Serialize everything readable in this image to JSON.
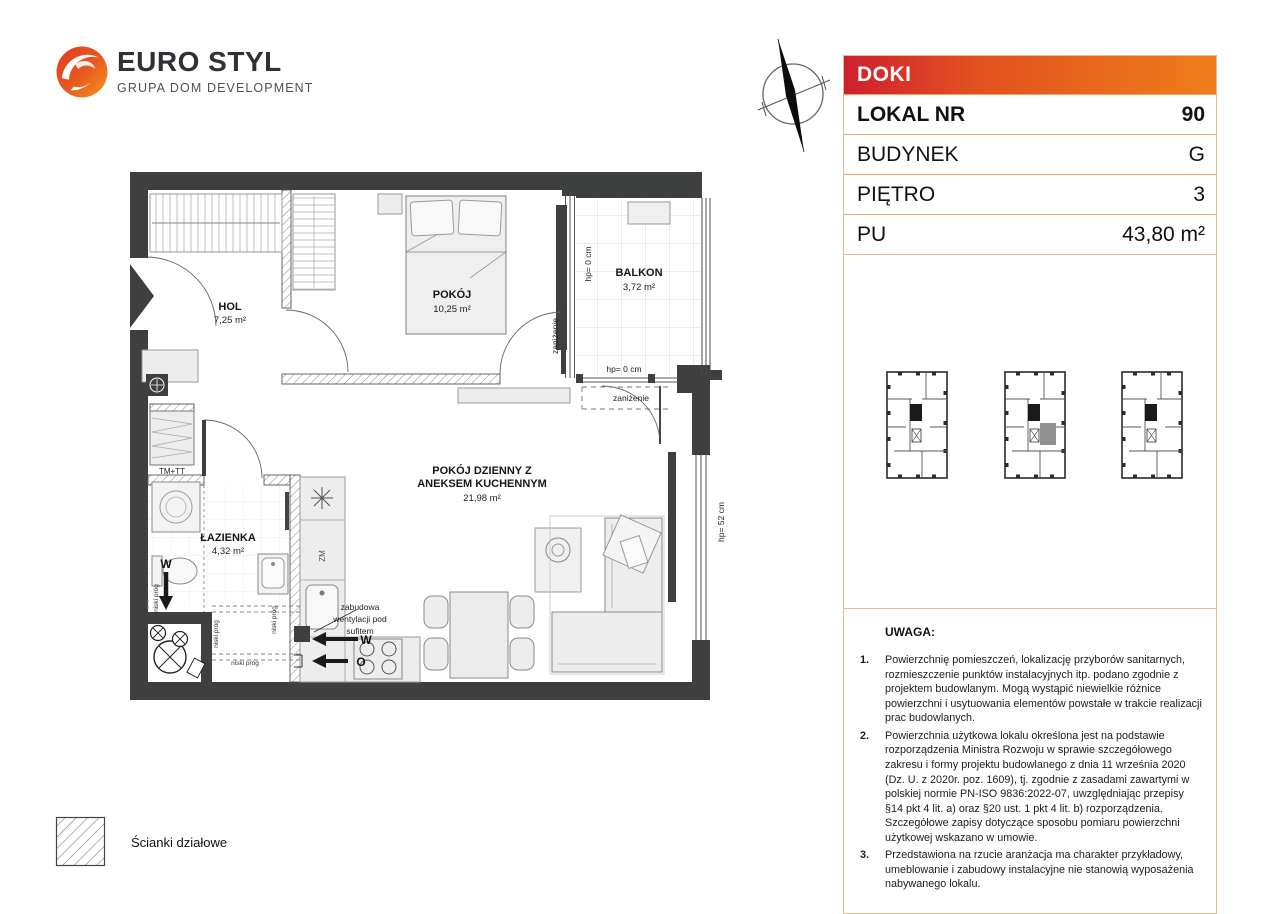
{
  "logo": {
    "title": "EURO STYL",
    "subtitle": "GRUPA DOM DEVELOPMENT"
  },
  "info_panel": {
    "project_name": "DOKI",
    "rows": [
      {
        "label": "LOKAL NR",
        "value": "90"
      },
      {
        "label": "BUDYNEK",
        "value": "G"
      },
      {
        "label": "PIĘTRO",
        "value": "3"
      },
      {
        "label": "PU",
        "value": "43,80 m²"
      }
    ],
    "colors": {
      "header_gradient_start": "#cf1f2f",
      "header_gradient_end": "#ef7d1a",
      "panel_border": "#dcc096",
      "row_border": "#efa760"
    }
  },
  "floor_plan": {
    "rooms": {
      "hol": {
        "name": "HOL",
        "area": "7,25 m²"
      },
      "pokoj": {
        "name": "POKÓJ",
        "area": "10,25 m²"
      },
      "balkon": {
        "name": "BALKON",
        "area": "3,72 m²"
      },
      "lazienka": {
        "name": "ŁAZIENKA",
        "area": "4,32 m²"
      },
      "pokoj_dzienny": {
        "name_line1": "POKÓJ DZIENNY Z",
        "name_line2": "ANEKSEM KUCHENNYM",
        "area": "21,98 m²"
      }
    },
    "annotations": {
      "hp_0": "hp= 0 cm",
      "hp_52": "hp= 52 cm",
      "zanizenie": "zaniżenie",
      "niski_prog": "niski próg",
      "tm_tt": "TM+TT",
      "zm": "ZM",
      "vent_line1": "zabudowa",
      "vent_line2": "wentylacji pod",
      "vent_line3": "sufitem",
      "w": "W",
      "o": "O"
    }
  },
  "location_plans": {
    "plans": [
      {
        "highlighted": false
      },
      {
        "highlighted": true
      },
      {
        "highlighted": false
      }
    ]
  },
  "notes": {
    "title": "UWAGA:",
    "items": [
      {
        "num": "1.",
        "text": "Powierzchnię pomieszczeń, lokalizację przyborów sanitarnych, rozmieszczenie punktów instalacyjnych itp. podano zgodnie z projektem budowlanym. Mogą wystąpić niewielkie różnice powierzchni i usytuowania elementów powstałe w trakcie realizacji prac budowlanych."
      },
      {
        "num": "2.",
        "text": "Powierzchnia użytkowa lokalu określona jest na podstawie rozporządzenia Ministra Rozwoju w sprawie szczegółowego zakresu i formy projektu budowlanego z dnia 11 września 2020 (Dz. U. z 2020r. poz. 1609), tj. zgodnie z zasadami zawartymi w polskiej normie PN-ISO 9836:2022-07, uwzględniając przepisy §14 pkt 4 lit. a) oraz §20 ust. 1 pkt 4 lit. b) rozporządzenia. Szczegółowe zapisy dotyczące sposobu pomiaru powierzchni użytkowej wskazano w umowie."
      },
      {
        "num": "3.",
        "text": "Przedstawiona na rzucie aranżacja ma charakter przykładowy, umeblowanie i zabudowy instalacyjne nie stanowią wyposażenia nabywanego lokalu."
      }
    ]
  },
  "legend": {
    "label": "Ścianki działowe"
  }
}
